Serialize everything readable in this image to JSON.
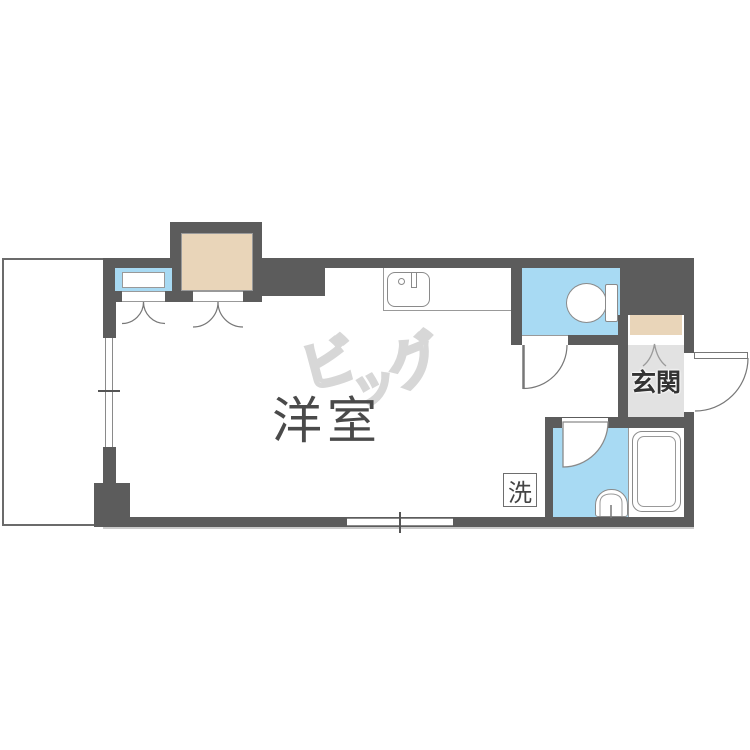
{
  "plan": {
    "type": "floorplan",
    "room_label": "洋室",
    "entrance_label": "玄関",
    "laundry_label": "洗",
    "watermark": {
      "char1": "ビ",
      "char2": "ッ",
      "char3": "グ"
    },
    "colors": {
      "wall": "#5c5c5c",
      "water_blue": "#a8daf3",
      "closet_tan": "#e9d5b9",
      "entrance_floor": "#e2e2e2",
      "fixture_outline": "#8a8a8a",
      "watermark_gray": "#d7d7d7"
    },
    "fixtures": [
      "kitchen-sink",
      "toilet",
      "bathtub",
      "wash-basin",
      "closet",
      "shoe-box",
      "washing-machine-space"
    ]
  }
}
